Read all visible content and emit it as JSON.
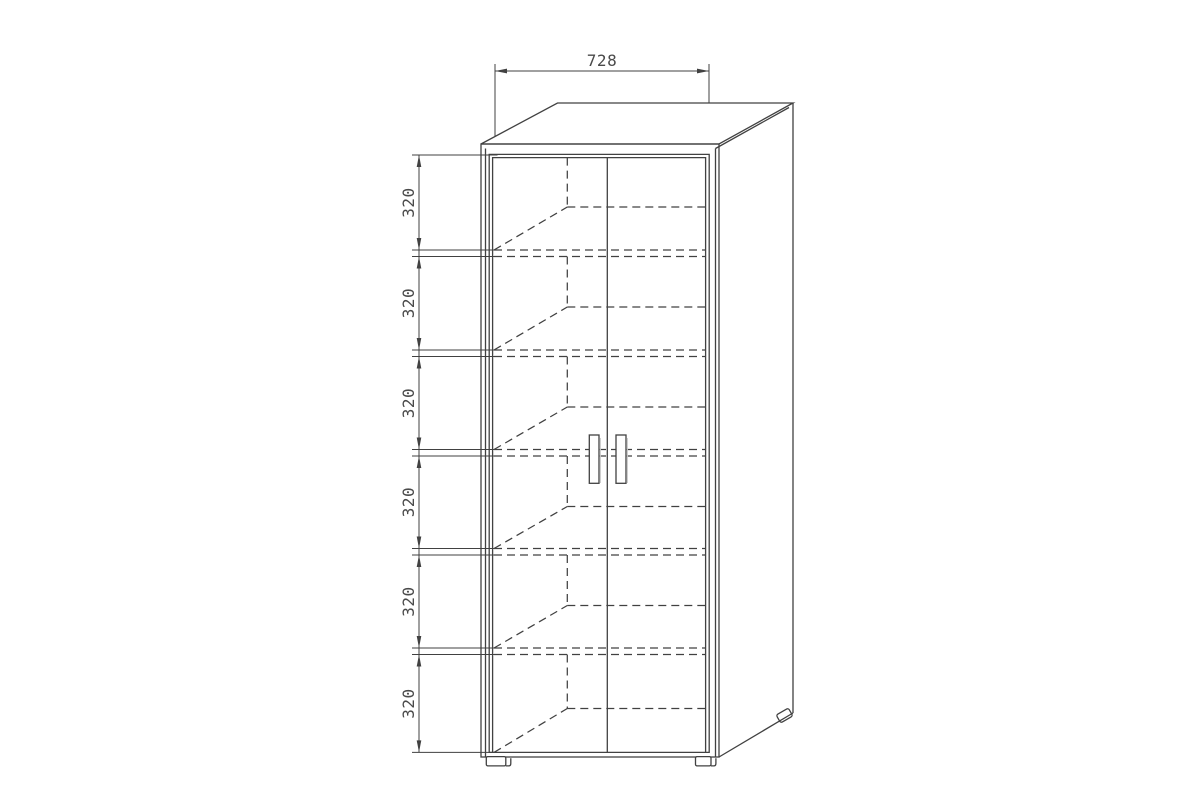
{
  "drawing": {
    "type": "furniture-technical-drawing",
    "subject": "two-door-cabinet-with-shelves",
    "width_dimension": {
      "label": "728",
      "value": 728
    },
    "shelf_spacing_dimensions": [
      {
        "label": "320",
        "value": 320
      },
      {
        "label": "320",
        "value": 320
      },
      {
        "label": "320",
        "value": 320
      },
      {
        "label": "320",
        "value": 320
      },
      {
        "label": "320",
        "value": 320
      },
      {
        "label": "320",
        "value": 320
      }
    ],
    "colors": {
      "line": "#414141",
      "text": "#4a4a4a",
      "background": "#ffffff",
      "handle_shade": "#c9c9c9"
    }
  }
}
